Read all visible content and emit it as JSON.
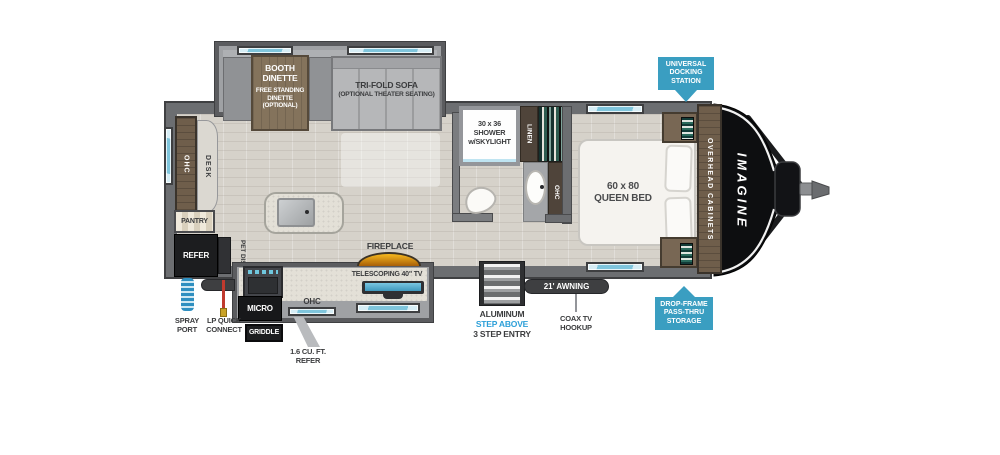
{
  "colors": {
    "badge_blue": "#3A9EC1",
    "step_above_blue": "#2C9FD8",
    "window_blue": "#A9D9EA",
    "fireplace_orange": "#EF9D1E",
    "label_dark": "#3B3C3E"
  },
  "living_area": {
    "booth_dinette_title": "BOOTH\nDINETTE",
    "booth_dinette_sub": "FREE STANDING\nDINETTE\n(OPTIONAL)",
    "sofa_title": "TRI-FOLD SOFA",
    "sofa_sub": "(OPTIONAL THEATER SEATING)",
    "ohc": "OHC",
    "desk": "DESK",
    "pantry": "PANTRY",
    "refer": "REFER",
    "pet_dish": "PET DISH",
    "fireplace": "FIREPLACE"
  },
  "kitchen": {
    "micro": "MICRO",
    "griddle": "GRIDDLE",
    "ohc": "OHC",
    "small_refer": "1.6 CU. FT.\nREFER",
    "tv": "TELESCOPING 40\" TV"
  },
  "bathroom": {
    "shower": "30 x 36\nSHOWER\nw/SKYLIGHT",
    "linen": "LINEN",
    "ohc": "OHC"
  },
  "bedroom": {
    "bed": "60 x 80\nQUEEN BED",
    "overhead_cabinets": "OVERHEAD CABINETS"
  },
  "exterior": {
    "brand": "IMAGINE",
    "docking_badge": "UNIVERSAL\nDOCKING\nSTATION",
    "storage_badge": "DROP-FRAME\nPASS-THRU\nSTORAGE",
    "spray_port": "SPRAY\nPORT",
    "lp_quick_connect": "LP QUICK\nCONNECT",
    "awning": "21' AWNING",
    "coax": "COAX TV\nHOOKUP",
    "step_line1": "ALUMINUM",
    "step_line2": "STEP ABOVE",
    "step_line3": "3 STEP ENTRY"
  }
}
